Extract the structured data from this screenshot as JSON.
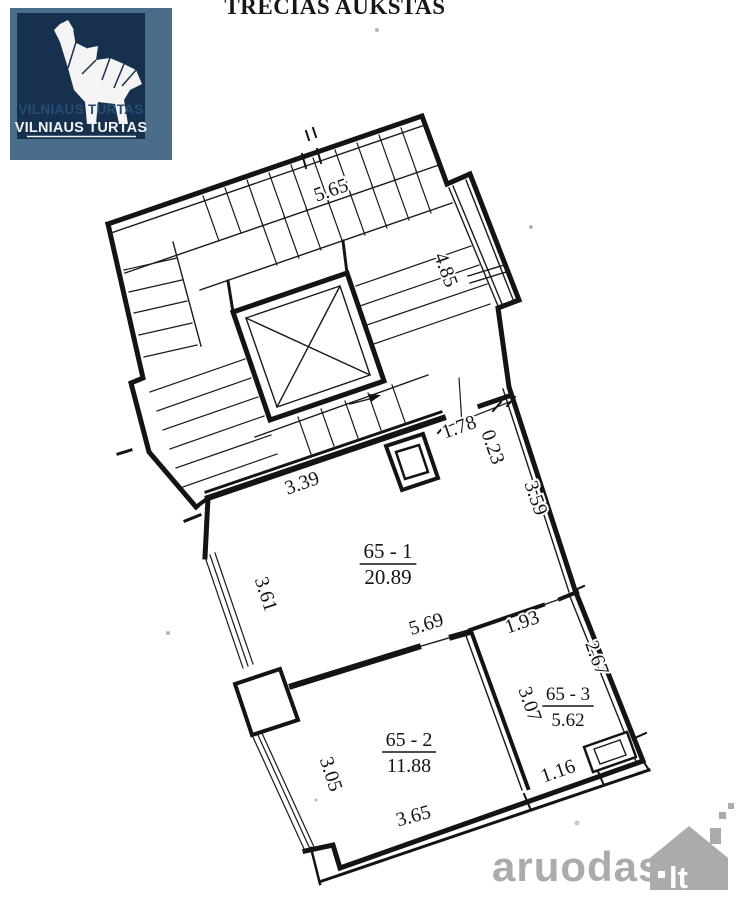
{
  "title": "TREČIAS AUKŠTAS",
  "logo": {
    "shadow": "VILNIAUS TURTAS",
    "line1": "VILNIAUS TURTAS",
    "frame_color": "#4a6d8c",
    "bg_color": "#16304e",
    "shadow_color": "#2a4d74",
    "text_color": "#f2f2f2"
  },
  "watermark": {
    "text": "aruodas",
    "suffix": "lt",
    "color": "#ababab"
  },
  "plan": {
    "ink_color": "#141414",
    "rooms": [
      {
        "label": "65 - 1",
        "area": "20.89",
        "x": 388,
        "y": 558,
        "font": 21
      },
      {
        "label": "65 - 2",
        "area": "11.88",
        "x": 409,
        "y": 746,
        "font": 20
      },
      {
        "label": "65 - 3",
        "area": "5.62",
        "x": 568,
        "y": 700,
        "font": 19
      }
    ],
    "dimensions": [
      {
        "text": "5.65",
        "x": 333,
        "y": 196,
        "rot": -19
      },
      {
        "text": "4.85",
        "x": 440,
        "y": 272,
        "rot": 70
      },
      {
        "text": "1.78",
        "x": 461,
        "y": 433,
        "rot": -19
      },
      {
        "text": "0.23",
        "x": 487,
        "y": 449,
        "rot": 71
      },
      {
        "text": "3.39",
        "x": 304,
        "y": 489,
        "rot": -19
      },
      {
        "text": "3.59",
        "x": 530,
        "y": 500,
        "rot": 71
      },
      {
        "text": "3.61",
        "x": 260,
        "y": 596,
        "rot": 72
      },
      {
        "text": "5.69",
        "x": 428,
        "y": 630,
        "rot": -17
      },
      {
        "text": "1.93",
        "x": 524,
        "y": 628,
        "rot": -19
      },
      {
        "text": "2.67",
        "x": 591,
        "y": 660,
        "rot": 70
      },
      {
        "text": "3.07",
        "x": 524,
        "y": 706,
        "rot": 71
      },
      {
        "text": "3.05",
        "x": 325,
        "y": 776,
        "rot": 72
      },
      {
        "text": "1.16",
        "x": 560,
        "y": 777,
        "rot": -19
      },
      {
        "text": "3.65",
        "x": 415,
        "y": 822,
        "rot": -15
      }
    ]
  }
}
